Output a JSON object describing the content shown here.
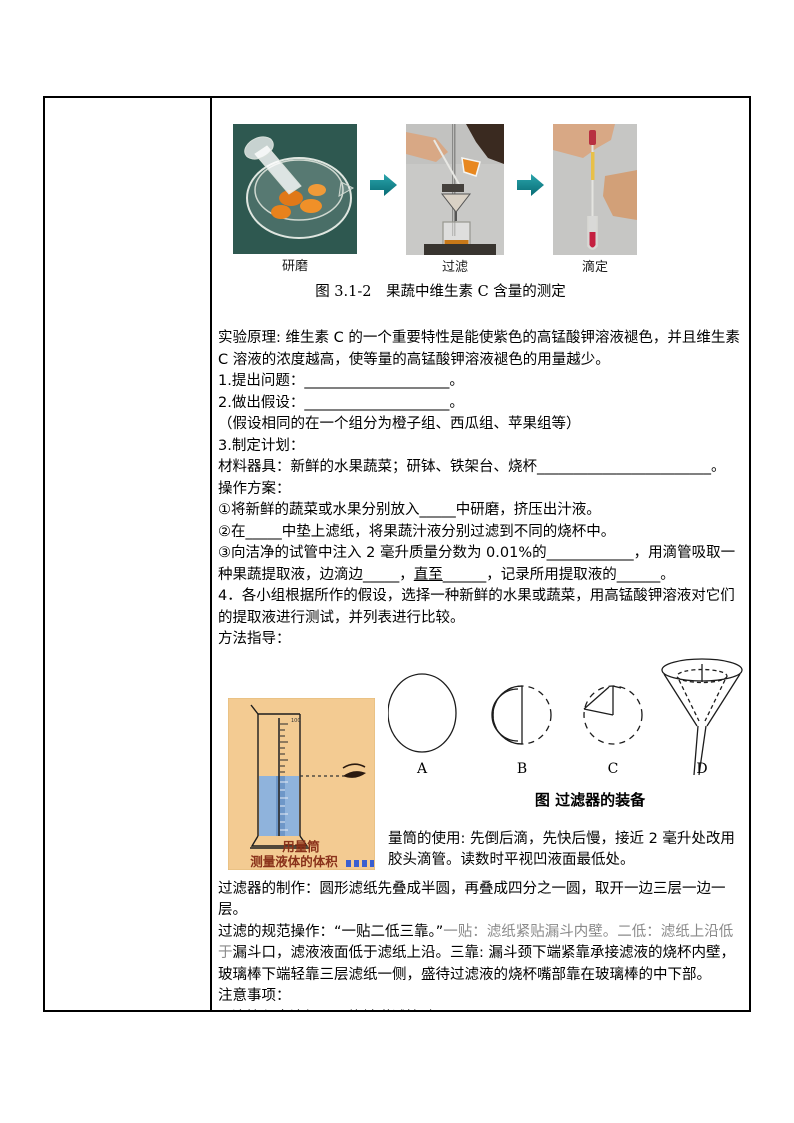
{
  "colors": {
    "arrow_teal": "#0e8590",
    "caption_maroon": "#8a321a",
    "gray_text": "#8a8a8a",
    "cylinder_bg": "#f3cb92",
    "liquid_blue": "#8fb3dc",
    "photo1_bg": "#2e5850",
    "photo_gray_bg": "#c9c9c7",
    "orange_juice": "#e8871e",
    "red_liquid": "#c42040",
    "yellow_liquid": "#e8c048"
  },
  "figure_measure": {
    "photo_labels": [
      "研磨",
      "过滤",
      "滴定"
    ],
    "caption": "图 3.1-2　果蔬中维生素 C 含量的测定"
  },
  "content": {
    "principle": "实验原理: 维生素 C 的一个重要特性是能使紫色的高锰酸钾溶液褪色，并且维生素 C 溶液的浓度越高，使等量的高锰酸钾溶液褪色的用量越少。",
    "q1": "1.提出问题：____________________。",
    "q2": "2.做出假设：____________________。",
    "hint": "（假设相同的在一个组分为橙子组、西瓜组、苹果组等）",
    "plan": "3.制定计划：",
    "materials": "材料器具：新鲜的水果蔬菜；研钵、铁架台、烧杯________________________。",
    "procedure_title": "操作方案：",
    "step1": "①将新鲜的蔬菜或水果分别放入_____中研磨，挤压出汁液。",
    "step2": "②在_____中垫上滤纸，将果蔬汁液分别过滤到不同的烧杯中。",
    "step3_a": "③向洁净的试管中注入 2 毫升质量分数为 0.01%的____________，用滴管吸取一种果蔬提取液，边滴边_____，",
    "step3_underlined": "直至",
    "step3_b": "______，记录所用提取液的______。",
    "step4": "4．各小组根据所作的假设，选择一种新鲜的水果或蔬菜，用高锰酸钾溶液对它们的提取液进行测试，并列表进行比较。",
    "guide_title": "方法指导："
  },
  "figure_filter": {
    "labels": [
      "A",
      "B",
      "C",
      "D"
    ],
    "caption": "图  过滤器的装备"
  },
  "cylinder": {
    "caption_line1": "用量筒",
    "caption_line2": "测量液体的体积"
  },
  "lower": {
    "cylinder_use": "量筒的使用: 先倒后滴，先快后慢，接近 2 毫升处改用胶头滴管。读数时平视凹液面最低处。",
    "filter_making": "过滤器的制作：圆形滤纸先叠成半圆，再叠成四分之一圆，取开一边三层一边一层。",
    "filter_rule_head": "过滤的规范操作：“一贴二低三靠。”",
    "filter_rule_gray": "一贴：滤纸紧贴漏斗内壁。二低：滤纸上沿低于",
    "filter_rule_rest": "漏斗口，滤液液面低于滤纸上沿。三靠: 漏斗颈下端紧靠承接滤液的烧杯内壁，玻璃棒下端轻靠三层滤纸一侧，盛待过滤液的烧杯嘴部靠在玻璃棒的中下部。",
    "notes_title": "注意事项：",
    "note1": "1.滴管竖直滴加，不能触碰试管壁。",
    "note2": "2.一定要逐渐滴加入，边滴加振荡边观察，避免滴加过多，影响计数的准确性。"
  }
}
